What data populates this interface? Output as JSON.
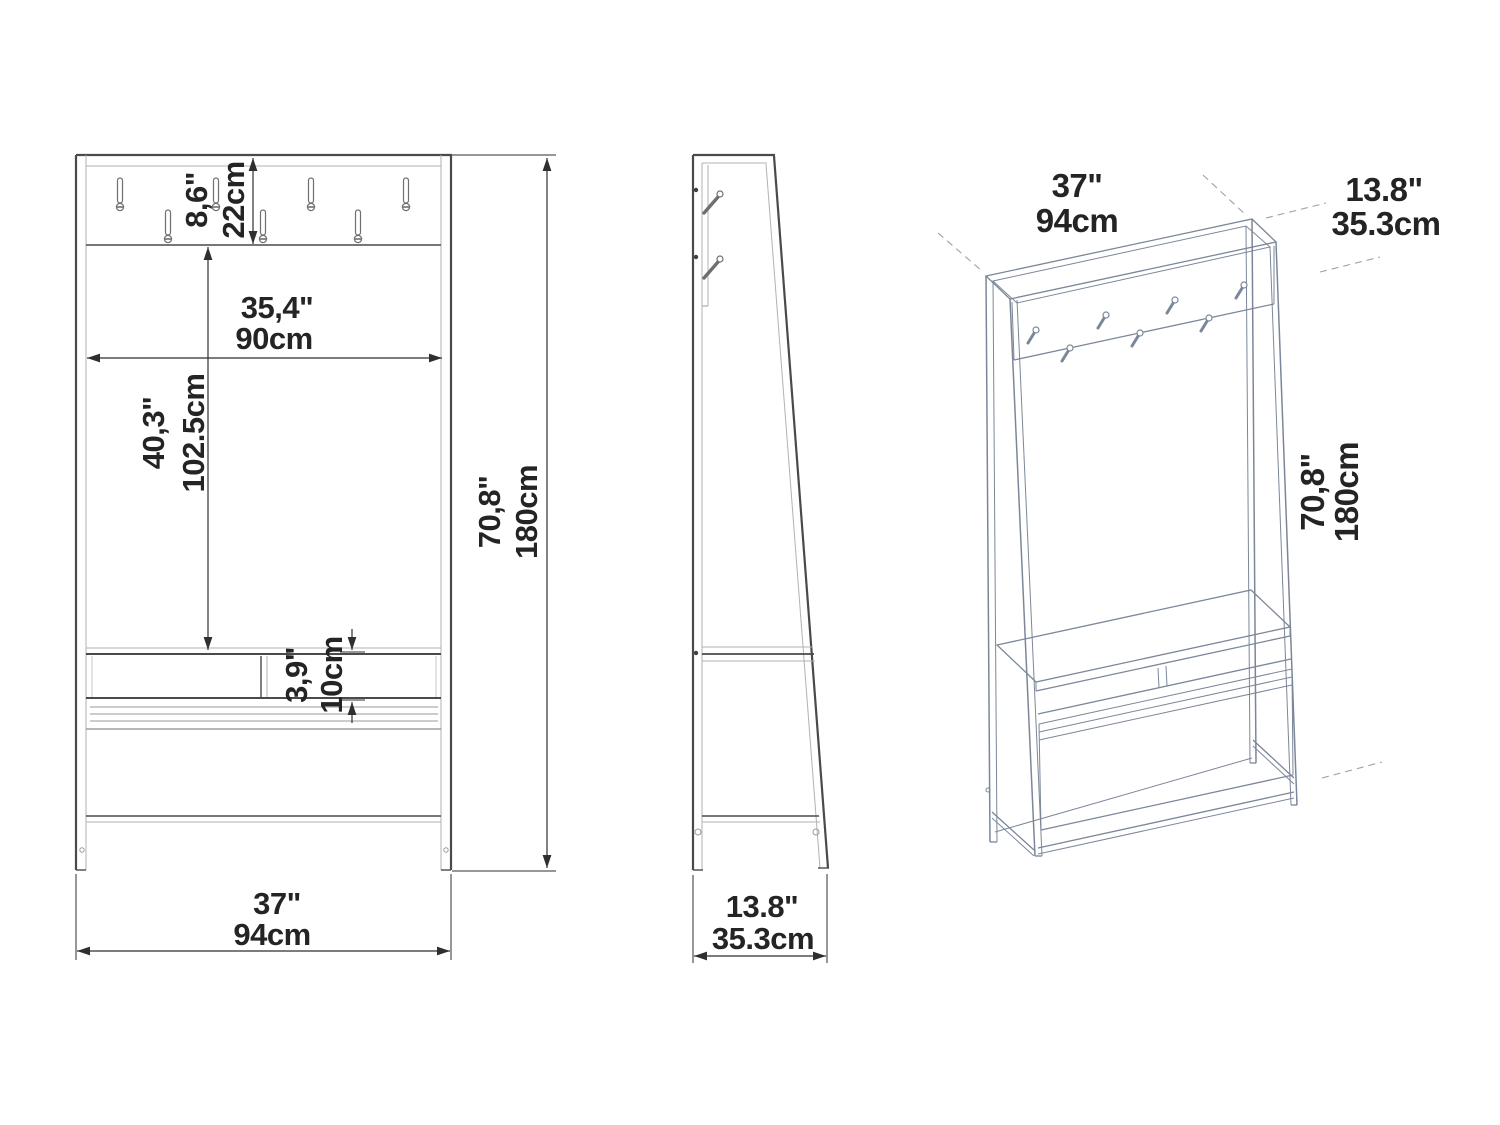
{
  "drawing": {
    "kind": "furniture dimension drawing",
    "product": "hall tree with coat hooks, bench and shoe storage"
  },
  "front_view": {
    "hooks": 7,
    "dim_hook_panel_in": "8,6\"",
    "dim_hook_panel_cm": "22cm",
    "dim_inner_width_in": "35,4\"",
    "dim_inner_width_cm": "90cm",
    "dim_panel_to_bench_in": "40,3\"",
    "dim_panel_to_bench_cm": "102.5cm",
    "dim_bench_gap_in": "3,9\"",
    "dim_bench_gap_cm": "10cm",
    "dim_height_in": "70,8\"",
    "dim_height_cm": "180cm",
    "dim_width_in": "37\"",
    "dim_width_cm": "94cm"
  },
  "side_view": {
    "dim_depth_in": "13.8\"",
    "dim_depth_cm": "35.3cm"
  },
  "iso_view": {
    "dim_width_in": "37\"",
    "dim_width_cm": "94cm",
    "dim_depth_in": "13.8\"",
    "dim_depth_cm": "35.3cm",
    "dim_height_in": "70,8\"",
    "dim_height_cm": "180cm"
  },
  "colors": {
    "background": "#ffffff",
    "line_dark": "#4a4a4a",
    "line_light": "#b2b2b2",
    "dimension": "#2f2f2f",
    "iso_line": "#7b8799"
  }
}
